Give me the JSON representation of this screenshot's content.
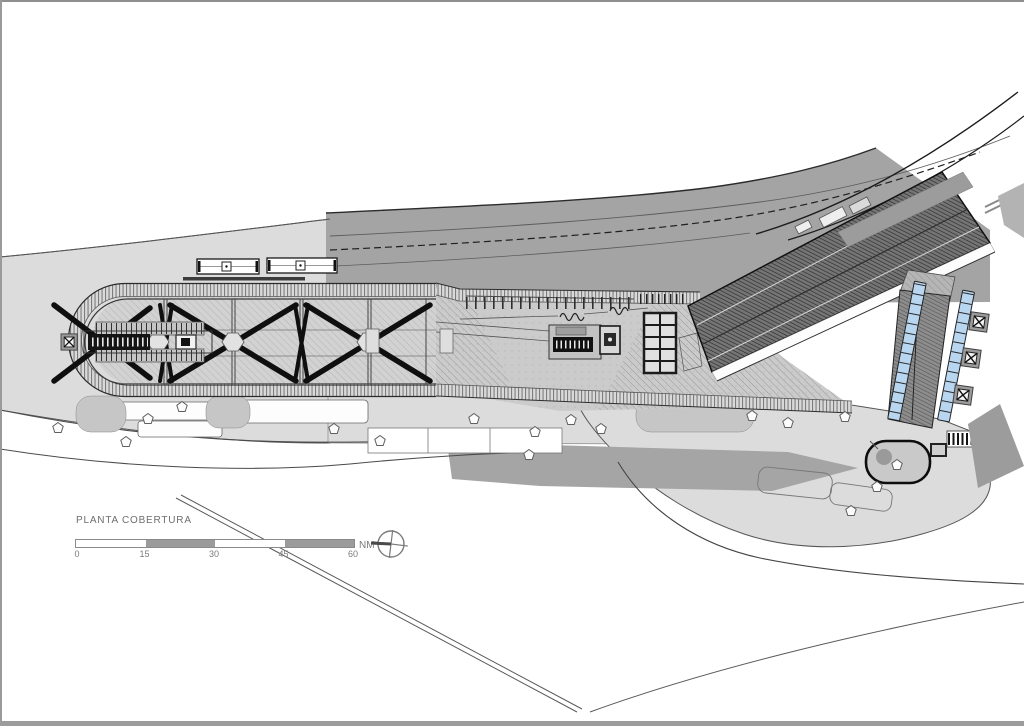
{
  "sheet": {
    "title": "PLANTA COBERTURA",
    "north": {
      "label": "NM"
    },
    "scale_bar": {
      "ticks": [
        "0",
        "15",
        "30",
        "45",
        "60"
      ]
    },
    "colors": {
      "site_light": "#dcdcdc",
      "corridor_gray": "#a4a4a4",
      "median_gray": "#a5a5a5",
      "roof_dark": "#757575",
      "panel_blue": "#b9d6f0",
      "plaza_gray": "#cbcbcb"
    }
  }
}
